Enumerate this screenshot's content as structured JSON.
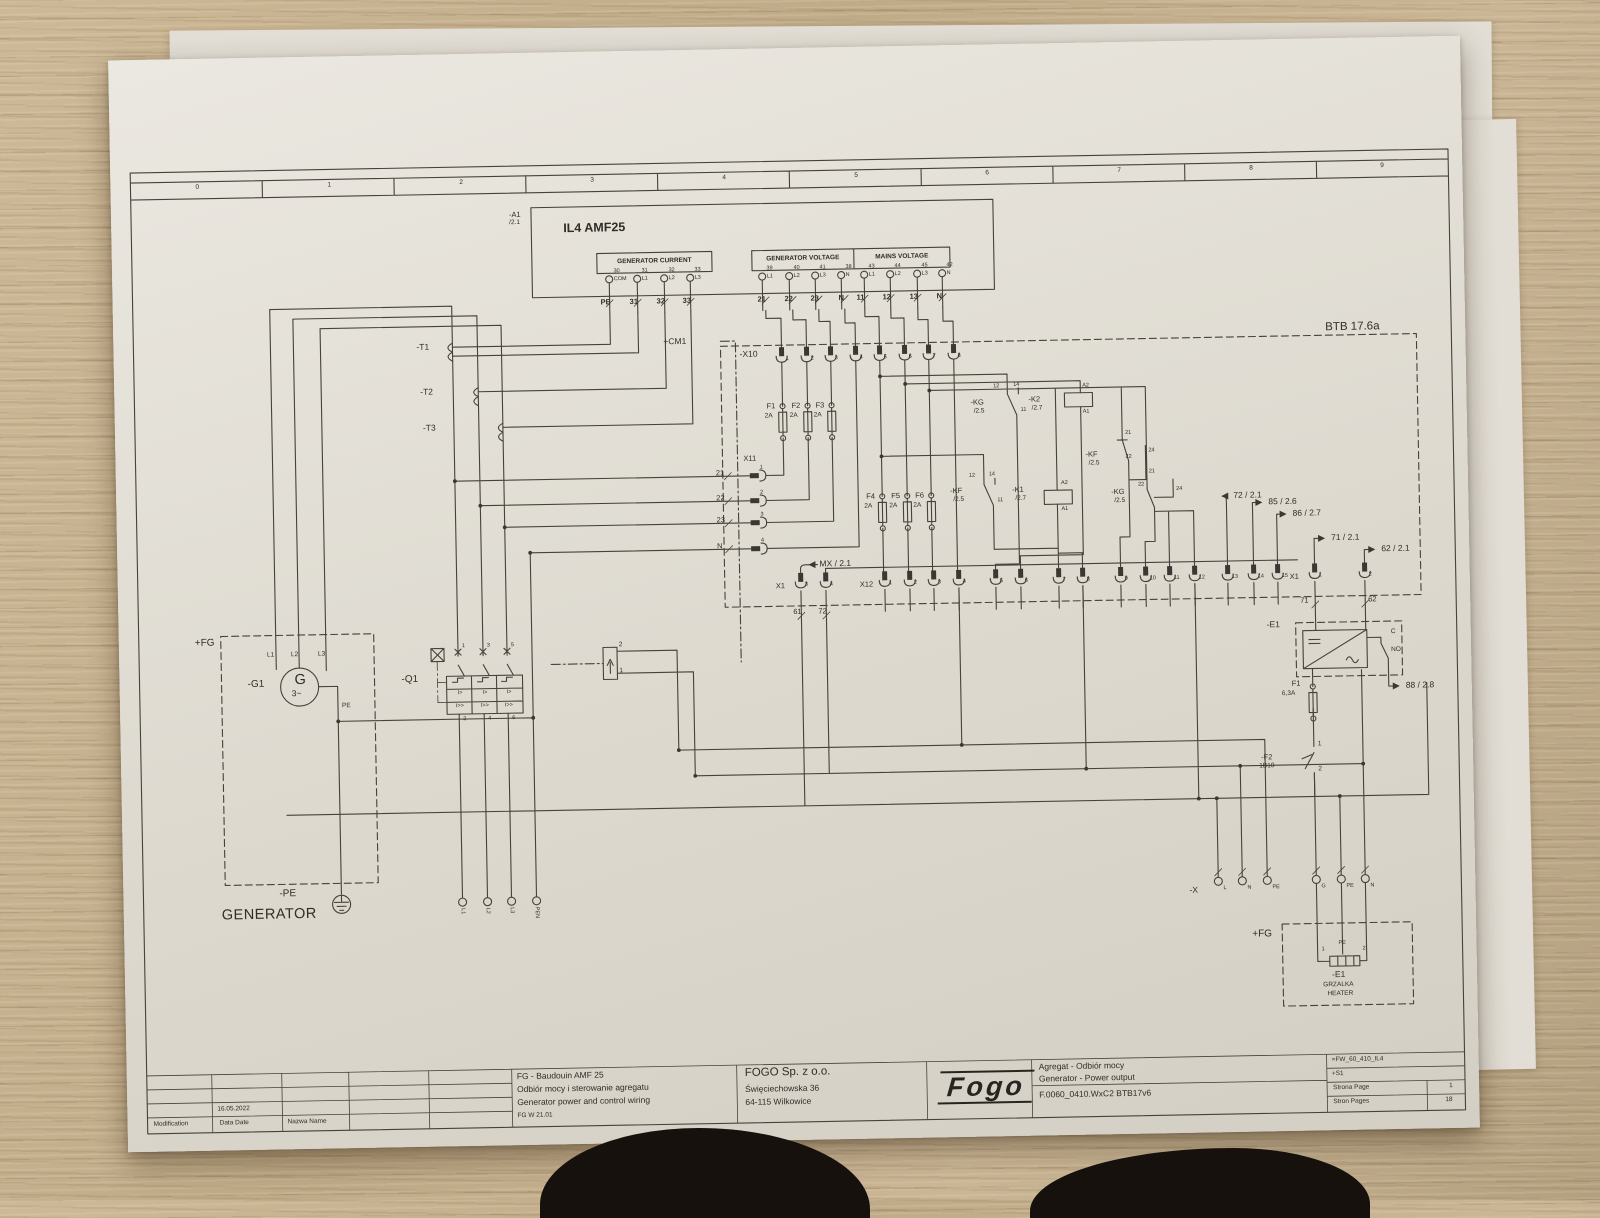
{
  "ruler": [
    "0",
    "1",
    "2",
    "3",
    "4",
    "5",
    "6",
    "7",
    "8",
    "9"
  ],
  "plc": {
    "ref": "-A1",
    "sheet": "/2.1",
    "title": "IL4 AMF25",
    "gc": {
      "title": "GENERATOR CURRENT",
      "pins": [
        {
          "t": "30",
          "b": "COM"
        },
        {
          "t": "31",
          "b": "L1"
        },
        {
          "t": "32",
          "b": "L2"
        },
        {
          "t": "33",
          "b": "L3"
        }
      ],
      "wires": [
        "PE",
        "31",
        "32",
        "33"
      ]
    },
    "gv": {
      "title": "GENERATOR VOLTAGE",
      "pins": [
        {
          "t": "39",
          "b": "L1"
        },
        {
          "t": "40",
          "b": "L2"
        },
        {
          "t": "41",
          "b": "L3"
        },
        {
          "t": "38",
          "b": "N"
        }
      ],
      "wires": [
        "21",
        "22",
        "23",
        "N"
      ]
    },
    "mv": {
      "title": "MAINS VOLTAGE",
      "pins": [
        {
          "t": "43",
          "b": "L1"
        },
        {
          "t": "44",
          "b": "L2"
        },
        {
          "t": "45",
          "b": "L3"
        },
        {
          "t": "42",
          "b": "N"
        }
      ],
      "wires": [
        "11",
        "12",
        "13",
        "N"
      ]
    }
  },
  "area": {
    "cm1": "+CM1",
    "btb": "BTB 17.6a"
  },
  "x10": {
    "label": "-X10",
    "terminals": [
      "1",
      "2",
      "3",
      "4",
      "5",
      "6",
      "7",
      "8"
    ]
  },
  "x11": {
    "label": "X11",
    "terminals": [
      "1",
      "2",
      "3",
      "4"
    ],
    "wires": [
      "21",
      "22",
      "23",
      "N"
    ]
  },
  "x12": {
    "label": "X12",
    "terminals": [
      "1",
      "2",
      "3",
      "4",
      "5",
      "6",
      "7",
      "8",
      "9",
      "10",
      "11",
      "12",
      "13",
      "14",
      "15"
    ]
  },
  "x1_left": {
    "label": "X1",
    "terminals": [
      "3",
      "4"
    ],
    "wires": [
      "61",
      "72"
    ]
  },
  "x1_right": {
    "label": "X1",
    "terminals": [
      "1",
      "2"
    ],
    "wires": [
      "71",
      "62"
    ]
  },
  "fuses": {
    "f1": {
      "id": "F1",
      "a": "2A"
    },
    "f2": {
      "id": "F2",
      "a": "2A"
    },
    "f3": {
      "id": "F3",
      "a": "2A"
    },
    "f4": {
      "id": "F4",
      "a": "2A"
    },
    "f5": {
      "id": "F5",
      "a": "2A"
    },
    "f6": {
      "id": "F6",
      "a": "2A"
    }
  },
  "relays": {
    "kg1": {
      "id": "-KG",
      "ref": "/2.5",
      "p12": "12",
      "p14": "14",
      "p11": "11"
    },
    "k2": {
      "id": "-K2",
      "ref": "/2.7",
      "a2": "A2",
      "a1": "A1"
    },
    "kf1": {
      "id": "-KF",
      "ref": "/2.5",
      "p12": "12",
      "p14": "14",
      "p11": "11"
    },
    "k1": {
      "id": "-K1",
      "ref": "/2.7",
      "a2": "A2",
      "a1": "A1"
    },
    "kf2": {
      "id": "-KF",
      "ref": "/2.5",
      "p21": "21",
      "p22": "22",
      "p24": "24",
      "p21b": "21"
    },
    "kg2": {
      "id": "-KG",
      "ref": "/2.5",
      "p22": "22",
      "p24": "24"
    }
  },
  "arrows": {
    "mx": "MX / 2.1",
    "a72": "72 / 2.1",
    "a85": "85 / 2.6",
    "a86": "86 / 2.7",
    "a71": "71 / 2.1",
    "a62": "62 / 2.1",
    "a88": "88 / 2.8"
  },
  "generator": {
    "fg": "+FG",
    "ref": "-G1",
    "g": "G",
    "ph": "3~",
    "l1": "L1",
    "l2": "L2",
    "l3": "L3",
    "pe": "PE",
    "pe_ref": "-PE",
    "caption": "GENERATOR"
  },
  "ct": {
    "t1": "-T1",
    "t2": "-T2",
    "t3": "-T3"
  },
  "q1": {
    "ref": "-Q1",
    "top": [
      "1",
      "3",
      "5"
    ],
    "bottom": [
      "2",
      "4",
      "6"
    ],
    "i1": "I>",
    "i2": "I>>"
  },
  "bottom_terminals": [
    "L1",
    "L2",
    "L3",
    "PEN"
  ],
  "e1": {
    "ref": "-E1",
    "c": "C",
    "no": "NO",
    "fuse_id": "F1",
    "fuse_a": "6,3A"
  },
  "f2b": {
    "id": "-F2",
    "rating": "1B10",
    "p1": "1",
    "p2": "2"
  },
  "xb": {
    "label": "-X",
    "terms": [
      "L",
      "N",
      "PE",
      "G",
      "PE",
      "N"
    ]
  },
  "heater": {
    "fg": "+FG",
    "ref": "-E1",
    "pl": "GRZALKA",
    "en": "HEATER",
    "p1": "1",
    "p2": "2",
    "pe": "PE"
  },
  "ubox": {
    "p1": "1",
    "p2": "2"
  },
  "tb": {
    "rev": {
      "rows": [
        {
          "l": "Data Date",
          "v": "16.05.2022"
        },
        {
          "l": "Edycja. Ed.",
          "v": "andrzejk"
        },
        {
          "l": "Sprawdz Appr",
          "v": ""
        },
        {
          "l": "Original",
          "v": ""
        }
      ],
      "date2": "16.05.2022",
      "bottom": [
        "Modification",
        "Data Date",
        "Nazwa Name"
      ]
    },
    "desc": {
      "l1": "FG - Baudouin AMF 25",
      "l2": "Odbiór mocy i sterowanie agregatu",
      "l3": "Generator power and control wiring",
      "l4": "FG W 21.01"
    },
    "company": {
      "name": "FOGO Sp. z o.o.",
      "street": "Święciechowska 36",
      "city": "64-115 Wilkowice"
    },
    "logo": "Fogo",
    "project": {
      "l1": "Agregat - Odbiór mocy",
      "l2": "Generator - Power output",
      "l3": "F.0060_0410.WxC2 BTB17v6"
    },
    "code": "=FW_60_410_IL4",
    "s1": "+S1",
    "page_l": "Strona Page",
    "page_v": "1",
    "pages_l": "Stron Pages",
    "pages_v": "18"
  }
}
